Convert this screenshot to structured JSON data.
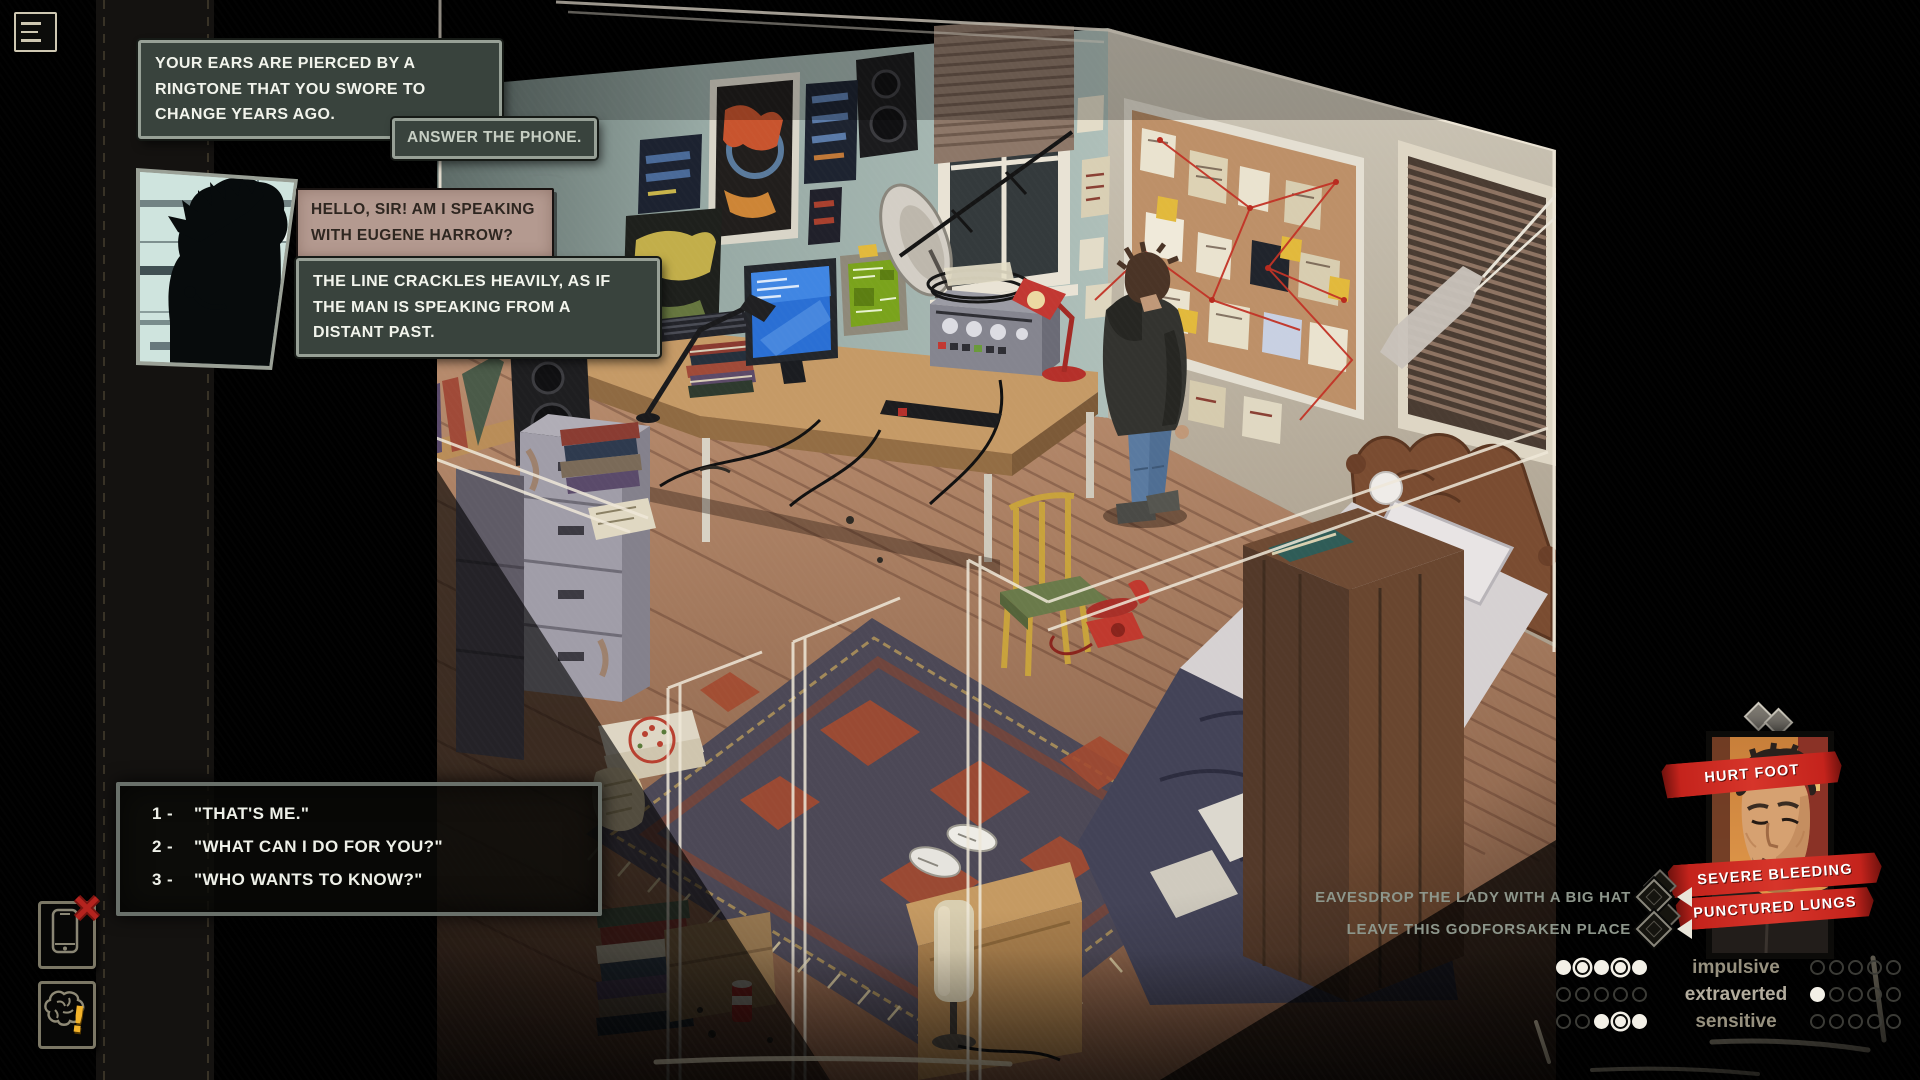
{
  "menu": {
    "icon": "hamburger-icon"
  },
  "narration": {
    "ringtone": "YOUR EARS ARE PIERCED BY A RINGTONE THAT YOU SWORE TO CHANGE YEARS AGO.",
    "crackles": "THE LINE CRACKLES HEAVILY, AS IF THE MAN IS SPEAKING FROM A DISTANT PAST."
  },
  "action_prompt": "ANSWER THE PHONE.",
  "caller": {
    "portrait_icon": "caller-silhouette-portrait",
    "line": "HELLO, SIR! AM I SPEAKING WITH EUGENE HARROW?"
  },
  "dialogue_options": [
    {
      "key": "1 -",
      "text": "\"THAT'S ME.\""
    },
    {
      "key": "2 -",
      "text": "\"WHAT CAN I DO FOR YOU?\""
    },
    {
      "key": "3 -",
      "text": "\"WHO WANTS TO KNOW?\""
    }
  ],
  "sidebar_icons": [
    {
      "name": "phone-icon",
      "badge": "x-badge",
      "badge_glyph": "✕"
    },
    {
      "name": "brain-icon",
      "badge": "exclamation-badge",
      "badge_glyph": "!"
    }
  ],
  "player": {
    "portrait_icon": "player-portrait",
    "conditions": [
      "HURT FOOT",
      "SEVERE BLEEDING",
      "PUNCTURED LUNGS"
    ]
  },
  "tasks": [
    "EAVESDROP THE LADY WITH A BIG HAT",
    "LEAVE THIS GODFORSAKEN PLACE"
  ],
  "traits": {
    "rows": [
      {
        "label": "impulsive",
        "left": [
          "filled",
          "ringed",
          "filled",
          "ringed",
          "filled"
        ],
        "right": [
          "empty",
          "empty",
          "empty",
          "empty",
          "empty"
        ]
      },
      {
        "label": "extraverted",
        "left": [
          "empty",
          "empty",
          "empty",
          "empty",
          "empty"
        ],
        "right": [
          "filled",
          "empty",
          "empty",
          "empty",
          "empty"
        ]
      },
      {
        "label": "sensitive",
        "left": [
          "empty",
          "empty",
          "filled",
          "ringed",
          "filled"
        ],
        "right": [
          "empty",
          "empty",
          "empty",
          "empty",
          "empty"
        ]
      }
    ]
  },
  "colors": {
    "banner_red": "#c4231c",
    "chalk": "#efe8d8",
    "hud_text": "#8d968b",
    "trait_text": "#97917f",
    "alert_yellow": "#f3b32a",
    "alert_red": "#b5231e"
  }
}
